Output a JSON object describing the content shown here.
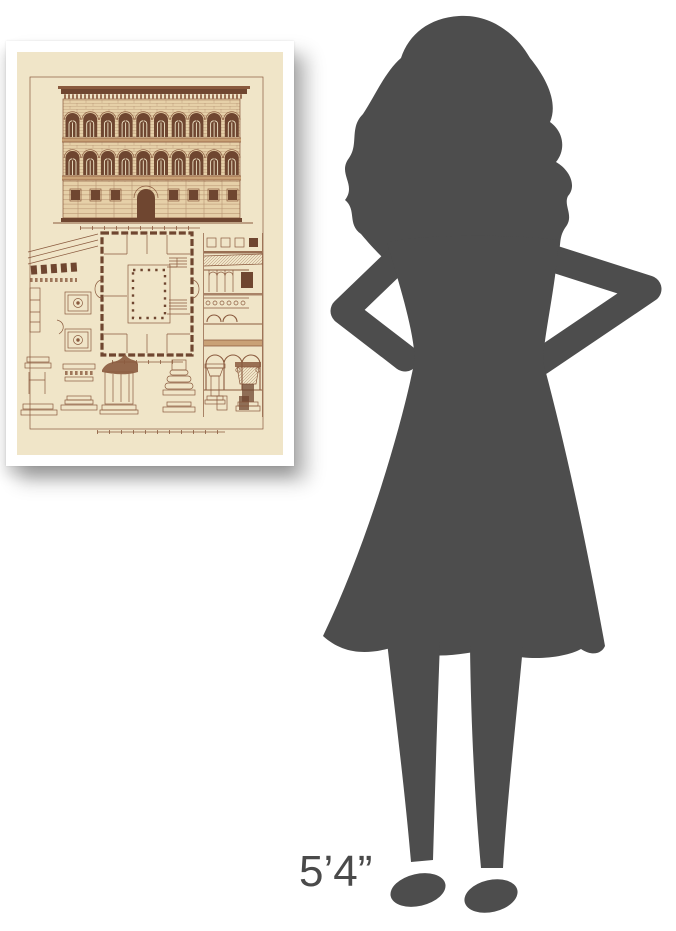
{
  "height_label": {
    "text": "5’4”"
  },
  "colors": {
    "background": "#ffffff",
    "silhouette": "#4d4d4d",
    "label": "#4a4a4a",
    "frame": "#ffffff",
    "paper": "#f0e5c8",
    "ink": "#8a5a3e",
    "ink-dark": "#6f4630",
    "wall": "#e6d0a8",
    "band": "#c9a176"
  },
  "print": {
    "parts": [
      "facade-elevation",
      "facade-scale-bar",
      "floor-plan",
      "courtyard-column-dots",
      "building-section",
      "cornice-detail",
      "rosette-coffer-panels",
      "molding-profiles",
      "column-capitals",
      "plate-scale-bar"
    ]
  },
  "figure": {
    "description": "woman-silhouette-height-reference"
  }
}
